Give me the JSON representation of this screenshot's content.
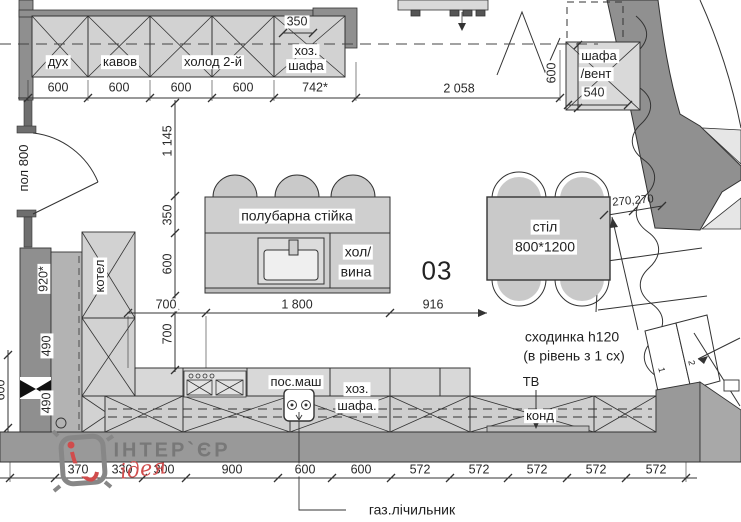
{
  "labels": {
    "oven": "дух",
    "coffee": "кавов",
    "fridge_second": "холод 2-й",
    "utility_top_line1": "хоз.",
    "utility_top_line2": "шафа",
    "vent_line1": "шафа",
    "vent_line2": "/вент",
    "door_opening": "пол 800",
    "boiler": "котел",
    "bar_counter": "полубарна стійка",
    "wine_line1": "хол/",
    "wine_line2": "вина",
    "room_number": "03",
    "table_line1": "стіл",
    "table_line2": "800*1200",
    "step_note_line1": "сходинка h120",
    "step_note_line2": "(в рівень з 1 сх)",
    "tv": "ТВ",
    "ac": "конд",
    "dishwasher": "пос.маш",
    "utility_bottom_line1": "хоз.",
    "utility_bottom_line2": "шафа.",
    "gas_meter": "газ.лічильник",
    "stair_step_1": "1",
    "stair_step_2": "2"
  },
  "dims": {
    "top": [
      "600",
      "600",
      "600",
      "600",
      "742*",
      "2 058"
    ],
    "top_inset": "350",
    "vent_width": "540",
    "vent_height": "600",
    "left_chain": [
      "1 145",
      "350",
      "600",
      "700"
    ],
    "left_wall_width": "920*",
    "left_wall_segments": [
      "490",
      "490"
    ],
    "left_edge_partial": "600",
    "island_row": [
      "700",
      "1 800",
      "916"
    ],
    "stair_treads": "270,270",
    "bottom": [
      "370",
      "330",
      "300",
      "900",
      "600",
      "600",
      "572",
      "572",
      "572",
      "572",
      "572"
    ]
  },
  "logo": {
    "brand": "ІНТЕР`ЄР",
    "tagline": "ідея"
  },
  "colors": {
    "wall": "#8f8f8f",
    "cabinet_fill": "#d2d2d2",
    "line": "#2e2e2e",
    "logo_red": "#d04c4c"
  }
}
